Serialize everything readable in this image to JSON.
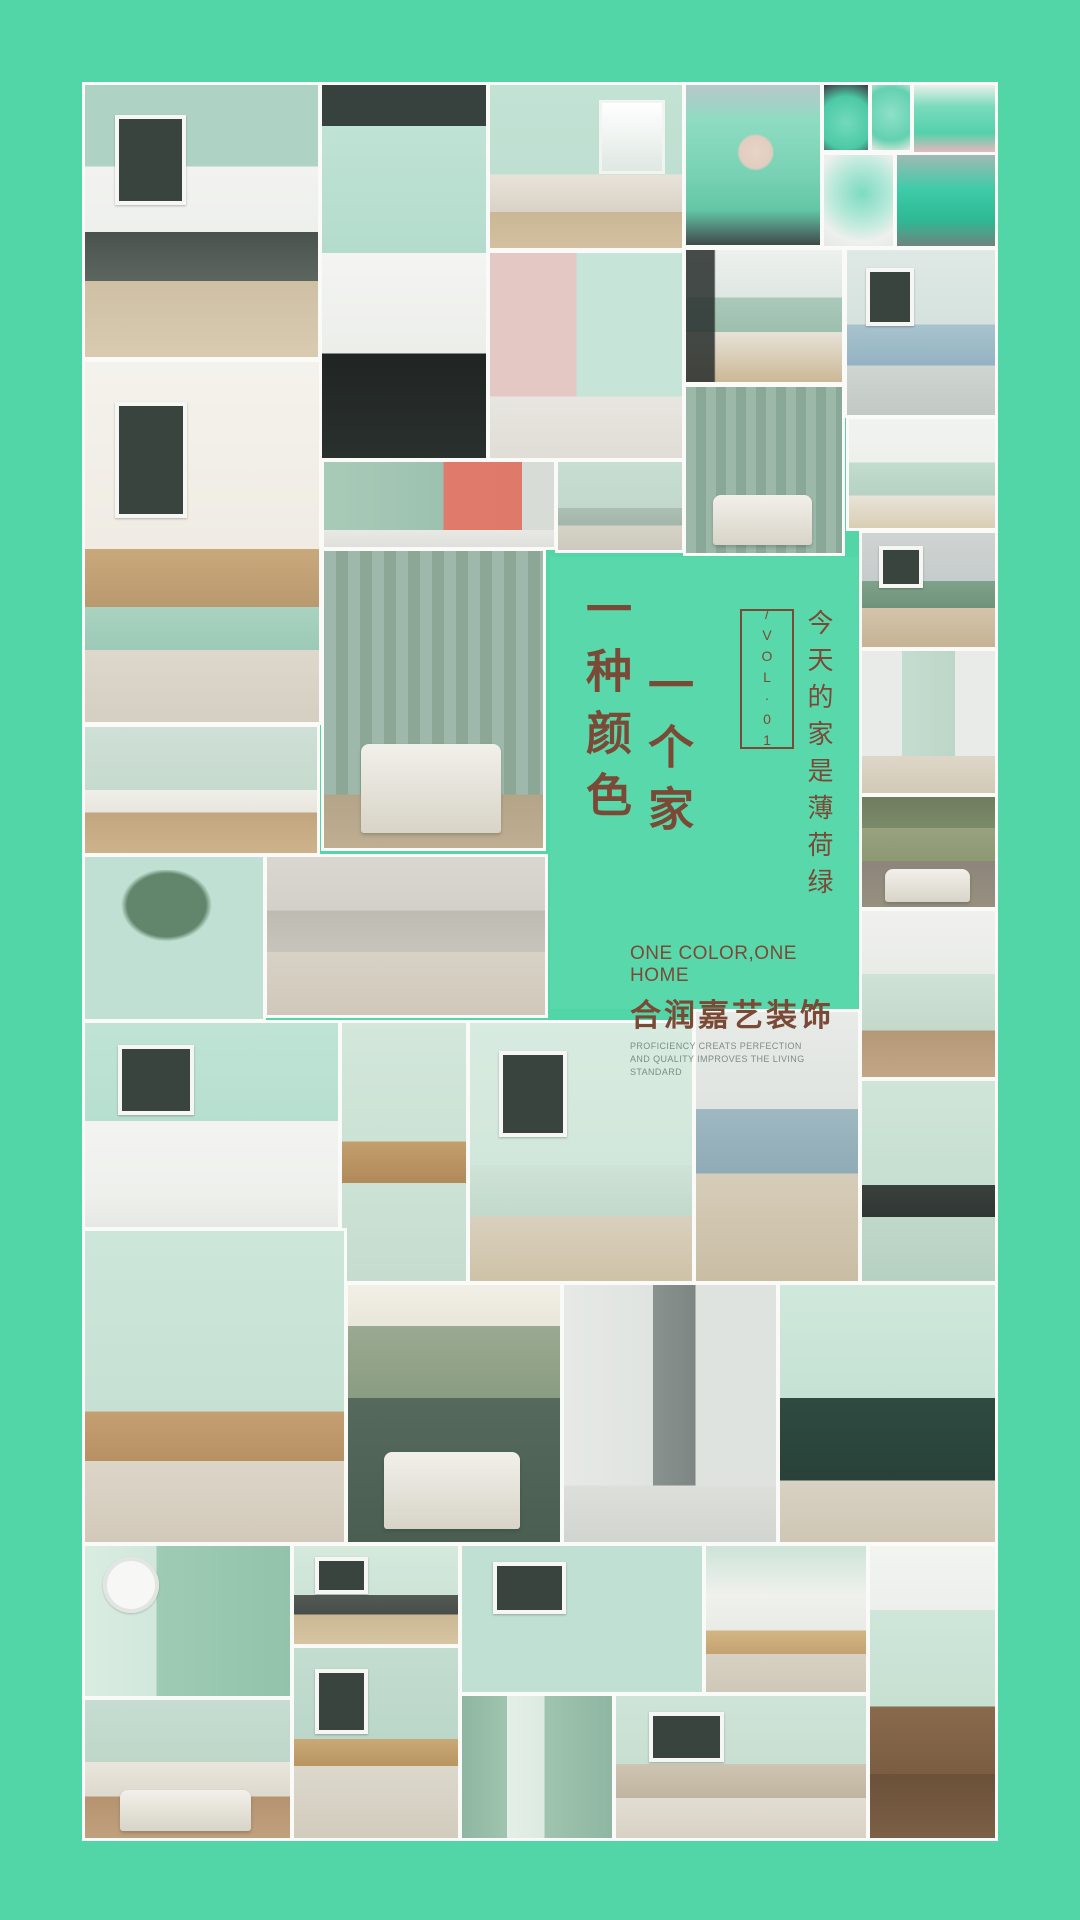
{
  "poster": {
    "background_color": "#52d6a7",
    "panel": {
      "background_color": "#59d8ab",
      "text_color": "#7b4a36",
      "sub_text_color": "#7d8d83",
      "headline_col1": "一种颜色",
      "headline_col2": "一个家",
      "volume_label": "/VOL·01",
      "slogan_vertical": "今天的家是薄荷绿",
      "tagline_en": "ONE COLOR,ONE HOME",
      "brand_name": "合润嘉艺装饰",
      "sub_en_line1": "PROFICIENCY CREATS PERFECTION",
      "sub_en_line2": "AND QUALITY IMPROVES THE LIVING STANDARD"
    },
    "tiles": [
      {
        "name": "living-room-gallery",
        "x": 85,
        "y": 85,
        "w": 233,
        "h": 272,
        "kind": "frame",
        "bg": "linear-gradient(180deg,#aed3c4 0%,#aed3c4 30%,#f2f3f0 30%,#eef0ec 54%,#4a524e 54%,#5c665f 72%,#cfc0a4 72%,#d8cbb0 100%)"
      },
      {
        "name": "bathroom-black-white",
        "x": 322,
        "y": 85,
        "w": 164,
        "h": 373,
        "kind": "none",
        "bg": "linear-gradient(180deg,#37423e 0%,#37423e 11%,#bfe3d5 11%,#b4dccd 45%,#f4f5f2 45%,#eceeea 72%,#202523 72%,#2a302d 100%)"
      },
      {
        "name": "bedroom-two-windows",
        "x": 490,
        "y": 85,
        "w": 192,
        "h": 163,
        "kind": "window",
        "bg": "linear-gradient(180deg,#c2e2d4 0%,#bedfd1 55%,#e8e3da 55%,#d9d2c6 78%,#c9b795 78%,#d2c0a0 100%)"
      },
      {
        "name": "nursery-pink-mint",
        "x": 490,
        "y": 253,
        "w": 192,
        "h": 205,
        "kind": "none",
        "bg": "linear-gradient(180deg,rgba(0,0,0,0) 70%,#e8e6e0 70%,#dfddd6 100%),linear-gradient(90deg,#e3c8c4 0%,#e3c8c4 45%,#c6e4d8 45%,#c6e4d8 100%)"
      },
      {
        "name": "girl-green-hair",
        "x": 686,
        "y": 85,
        "w": 134,
        "h": 160,
        "kind": "none",
        "bg": "radial-gradient(circle at 52% 42%,#e7d3c7 0%,#e2cdc0 14%,rgba(0,0,0,0) 16%),linear-gradient(180deg,#b9c7ca 0%,#8edcc2 22%,#79d2b4 55%,#63c7a6 78%,#41494a 100%)"
      },
      {
        "name": "teal-jar",
        "x": 824,
        "y": 85,
        "w": 44,
        "h": 65,
        "kind": "none",
        "bg": "radial-gradient(circle at 50% 58%,#73dabc 0%,#4cc9a6 60%,#3d3742 100%)"
      },
      {
        "name": "teal-cupcakes",
        "x": 872,
        "y": 85,
        "w": 38,
        "h": 65,
        "kind": "none",
        "bg": "radial-gradient(circle at 50% 45%,#8ee0c6 0%,#63d1b0 65%,#e9e7e3 100%)"
      },
      {
        "name": "teal-cake",
        "x": 914,
        "y": 85,
        "w": 81,
        "h": 67,
        "kind": "none",
        "bg": "linear-gradient(180deg,#e9f0ec 0%,#7adbbd 32%,#55d0ac 72%,#e6b8bb 100%)"
      },
      {
        "name": "teal-phone",
        "x": 824,
        "y": 155,
        "w": 69,
        "h": 91,
        "kind": "none",
        "bg": "radial-gradient(circle at 55% 42%,#7cdcc0 0%,#b9e9da 45%,#eef0ee 75%,#e6e8e6 100%)"
      },
      {
        "name": "teal-truck-bike",
        "x": 897,
        "y": 155,
        "w": 98,
        "h": 91,
        "kind": "none",
        "bg": "linear-gradient(180deg,#9fb9b3 0%,#3ecba8 38%,#2eb894 72%,#70847e 100%)"
      },
      {
        "name": "moodboard-dining",
        "x": 85,
        "y": 362,
        "w": 234,
        "h": 360,
        "kind": "frame",
        "bg": "linear-gradient(180deg,#f4f2ec 0%,#f0ece4 52%,#c9a87c 52%,#b9996e 68%,#a9d3c0 68%,#9bcab6 80%,#ded8cc 80%,#d5cfc2 100%)"
      },
      {
        "name": "kitchen-black-hood",
        "x": 686,
        "y": 250,
        "w": 156,
        "h": 132,
        "kind": "none",
        "bg": "linear-gradient(90deg,rgba(40,46,44,.85) 18%,rgba(0,0,0,0) 19%),linear-gradient(180deg,#eef1ee 0%,#dfe7e2 36%,#aac9bb 36%,#9dbfae 62%,#e7e3d8 62%,#cbb896 100%)"
      },
      {
        "name": "sp-poster-room",
        "x": 847,
        "y": 250,
        "w": 148,
        "h": 165,
        "kind": "frame",
        "bg": "linear-gradient(180deg,#dfe9e6 0%,#d5e2de 45%,#a9c3cf 45%,#94b3c2 70%,#cfd6d2 70%,#c2c9c4 100%)"
      },
      {
        "name": "ribbed-wall-bedroom",
        "x": 686,
        "y": 387,
        "w": 156,
        "h": 166,
        "kind": "bed",
        "bg": "repeating-linear-gradient(90deg,#9cb8a9 0 10px,#8aa897 10px 20px)"
      },
      {
        "name": "white-mint-kitchen",
        "x": 849,
        "y": 419,
        "w": 146,
        "h": 109,
        "kind": "none",
        "bg": "linear-gradient(180deg,#f1f3f0 0%,#eef0ec 40%,#c3dccd 40%,#b5d2c2 70%,#e9e4da 70%,#d9cdb4 100%)"
      },
      {
        "name": "shower-coral-vanity",
        "x": 324,
        "y": 462,
        "w": 230,
        "h": 85,
        "kind": "none",
        "bg": "linear-gradient(180deg,rgba(0,0,0,0) 80%,#e8e9e5 80%,#dfe0dc 100%),linear-gradient(90deg,#a8cbb8 0%,#9cc2af 52%,#e07a6a 52%,#df7a6a 86%,#d8dcd6 86%)"
      },
      {
        "name": "cabinet-rug",
        "x": 558,
        "y": 462,
        "w": 124,
        "h": 88,
        "kind": "none",
        "bg": "linear-gradient(180deg,#c9ded2 0%,#c2d8cc 52%,#aebfb4 52%,#a3b6aa 72%,#d6d3c8 72%,#cdc9bc 100%)"
      },
      {
        "name": "green-sofa-lounge",
        "x": 862,
        "y": 533,
        "w": 133,
        "h": 114,
        "kind": "frame",
        "bg": "linear-gradient(180deg,#cfd4d2 0%,#c6cccb 42%,#7fa28c 42%,#6f9279 66%,#d3c4ab 66%,#c6b394 100%)"
      },
      {
        "name": "doorway-room",
        "x": 862,
        "y": 651,
        "w": 133,
        "h": 142,
        "kind": "none",
        "bg": "linear-gradient(180deg,rgba(0,0,0,0) 74%,#ded7c8 74%,#d2c9b6 100%),linear-gradient(90deg,#e9ebe8 0%,#e9ebe8 30%,#c5ddd0 30%,#bdd6c8 70%,#e9ebe8 70%)"
      },
      {
        "name": "olive-bed-room",
        "x": 862,
        "y": 797,
        "w": 133,
        "h": 110,
        "kind": "bed",
        "bg": "linear-gradient(180deg,#6f7d5e 0%,#7b8a68 28%,#98a27e 28%,#8d9973 58%,#8d857b 58%,#97907f 100%)"
      },
      {
        "name": "slat-wall-bedroom",
        "x": 324,
        "y": 551,
        "w": 219,
        "h": 297,
        "kind": "bed",
        "bg": "linear-gradient(180deg,rgba(0,0,0,0) 82%,#b4a488 82%,#bfae91 100%),repeating-linear-gradient(90deg,#9eb9ab 0 12px,#8ca795 12px 24px)"
      },
      {
        "name": "reading-corner",
        "x": 85,
        "y": 727,
        "w": 232,
        "h": 126,
        "kind": "none",
        "bg": "linear-gradient(180deg,#cfe0d6 0%,#c6dacd 50%,#f0efe9 50%,#e8e5dd 68%,#c1a57e 68%,#cdb38c 100%)"
      },
      {
        "name": "tree-panel-wall",
        "x": 85,
        "y": 857,
        "w": 178,
        "h": 162,
        "kind": "plant",
        "bg": "linear-gradient(180deg,#c4ddd0 0%,#bcd6c9 70%,#b0c9bc 86%,#9c7a54 86%,#a8severe 0,#a8865e 100%)"
      },
      {
        "name": "loft-kitchen",
        "x": 267,
        "y": 857,
        "w": 278,
        "h": 158,
        "kind": "none",
        "bg": "linear-gradient(180deg,#d9d7d0 0%,#d2d0c8 34%,#bdbbb2 34%,#c6c4bb 60%,#d8d2c6 60%,#cfc8ba 100%)"
      },
      {
        "name": "pendant-doorway-room",
        "x": 862,
        "y": 911,
        "w": 133,
        "h": 166,
        "kind": "none",
        "bg": "linear-gradient(180deg,#f0f1ee 0%,#e9ebe7 38%,#cfe2d6 38%,#c3d9cb 72%,#b59877 72%,#c2a685 100%)"
      },
      {
        "name": "wc-black-pipes",
        "x": 85,
        "y": 1023,
        "w": 253,
        "h": 204,
        "kind": "frame",
        "bg": "linear-gradient(180deg,#bfe4d6 0%,#b7dfd0 48%,#f3f4f1 48%,#eef0ec 85%,#e6e8e4 100%)"
      },
      {
        "name": "stairs-plant",
        "x": 342,
        "y": 1023,
        "w": 124,
        "h": 258,
        "kind": "none",
        "bg": "linear-gradient(180deg,#d3e7db 0%,#cce2d5 46%,#c39f6d 46%,#b08a58 62%,#cce2d5 62%,#c6dccf 100%)"
      },
      {
        "name": "cactus-rattan-chair",
        "x": 470,
        "y": 1023,
        "w": 222,
        "h": 258,
        "kind": "frame",
        "bg": "linear-gradient(180deg,#d8ebe0 0%,#d2e7db 55%,#cfe3d6 55%,#c2d9cb 75%,#d9d0bd 75%,#cec2a8 100%)"
      },
      {
        "name": "kitchen-island-glass",
        "x": 696,
        "y": 1012,
        "w": 162,
        "h": 269,
        "kind": "none",
        "bg": "linear-gradient(180deg,#e8ebe8 0%,#dfe4e0 36%,#9fb8c2 36%,#8fabb6 60%,#d6cdb9 60%,#c9bda4 100%)"
      },
      {
        "name": "black-box-shelves",
        "x": 862,
        "y": 1081,
        "w": 133,
        "h": 200,
        "kind": "none",
        "bg": "linear-gradient(180deg,#cfe5d8 0%,#c6dfd1 52%,#3a413d 52%,#2f3633 68%,#c0d8ca 68%,#b6d0c1 100%)"
      },
      {
        "name": "dining-cane-chairs",
        "x": 85,
        "y": 1231,
        "w": 259,
        "h": 311,
        "kind": "none",
        "bg": "linear-gradient(180deg,#cde6da 0%,#c6e1d3 58%,#c49f72 58%,#b89163 74%,#ddd6c8 74%,#d2c9ba 100%)"
      },
      {
        "name": "bed-niche-green",
        "x": 348,
        "y": 1285,
        "w": 212,
        "h": 257,
        "kind": "bed",
        "bg": "linear-gradient(180deg,#f2efe6 0%,#e9e6da 16%,#9aaa92 16%,#8a9c82 44%,#55695c 44%,#4a5e52 100%)"
      },
      {
        "name": "gray-chair-doors",
        "x": 564,
        "y": 1285,
        "w": 212,
        "h": 257,
        "kind": "none",
        "bg": "linear-gradient(180deg,rgba(0,0,0,0) 78%,#dcdfda 78%,#d1d5cf 100%),linear-gradient(90deg,#e6e9e6 0%,#e0e4e0 42%,#8a9290 42%,#7d8683 62%,#dfe3df 62%)"
      },
      {
        "name": "darkgreen-kitchen-shelf",
        "x": 780,
        "y": 1285,
        "w": 215,
        "h": 257,
        "kind": "none",
        "bg": "linear-gradient(180deg,#cfe8db 0%,#c6e2d4 44%,#2f4a40 44%,#28423a 76%,#d8d2c4 76%,#cfc6b4 100%)"
      },
      {
        "name": "clock-wreath-wall",
        "x": 85,
        "y": 1546,
        "w": 205,
        "h": 150,
        "kind": "clock",
        "bg": "linear-gradient(90deg,#d9ece1 0%,#d2e8dc 35%,#9ecbb4 35%,#93c3ab 100%)"
      },
      {
        "name": "bedroom-wood-bed",
        "x": 85,
        "y": 1700,
        "w": 205,
        "h": 138,
        "kind": "bed",
        "bg": "linear-gradient(180deg,#c6ddd1 0%,#bed7c9 45%,#e9e6dd 45%,#ded9cd 70%,#b59371 70%,#c1a07e 100%)"
      },
      {
        "name": "sofa-posters-room",
        "x": 294,
        "y": 1546,
        "w": 164,
        "h": 98,
        "kind": "frame",
        "bg": "linear-gradient(180deg,#d5e9dd 0%,#cde4d7 50%,#535a56 50%,#474e4a 70%,#cbb894 70%,#d6c5a2 100%)"
      },
      {
        "name": "bed-triangle-art",
        "x": 294,
        "y": 1648,
        "w": 164,
        "h": 190,
        "kind": "frame",
        "bg": "linear-gradient(180deg,#c3ddd0 0%,#bbd7c9 48%,#c9a977 48%,#b99560 62%,#dcd8cc 62%,#d2ccbd 100%)"
      },
      {
        "name": "pineapple-dining",
        "x": 462,
        "y": 1546,
        "w": 240,
        "h": 146,
        "kind": "frame",
        "bg": "linear-gradient(180deg,#d9ece1 0%,#d2e8dc 52%,#d9b886 52%,#c8a univ 0,#c8a46f 72%,#b5906066 0,#b59060 100%)"
      },
      {
        "name": "console-room",
        "x": 706,
        "y": 1546,
        "w": 160,
        "h": 146,
        "kind": "none",
        "bg": "linear-gradient(180deg,#cde4d8 0%,#f0f1ed 34%,#e9ebe6 58%,#d3b584 58%,#c4a271 74%,#d8d2c4 74%,#cfc8b8 100%)"
      },
      {
        "name": "green-hallway-mirrors",
        "x": 462,
        "y": 1696,
        "w": 150,
        "h": 142,
        "kind": "none",
        "bg": "linear-gradient(90deg,#8fb6a2 0%,#9fc4b0 30%,#e4efe7 30%,#dceae1 55%,#9fc4b0 55%,#8fb6a2 100%)"
      },
      {
        "name": "beige-sofa-room",
        "x": 616,
        "y": 1696,
        "w": 250,
        "h": 142,
        "kind": "frame",
        "bg": "linear-gradient(180deg,#cfe4d8 0%,#c8dfd2 48%,#cec4b2 48%,#c0b5a0 72%,#e2ddd2 72%,#d8d2c4 100%)"
      },
      {
        "name": "veranda-hammock",
        "x": 870,
        "y": 1546,
        "w": 125,
        "h": 292,
        "kind": "none",
        "bg": "linear-gradient(180deg,#f2f4f1 0%,#ecefeb 22%,#cfe6da 22%,#c6e0d2 55%,#8a6a4c 55%,#7a5d42 78%,#6b5138 78%,#7b6046 100%)"
      }
    ]
  }
}
